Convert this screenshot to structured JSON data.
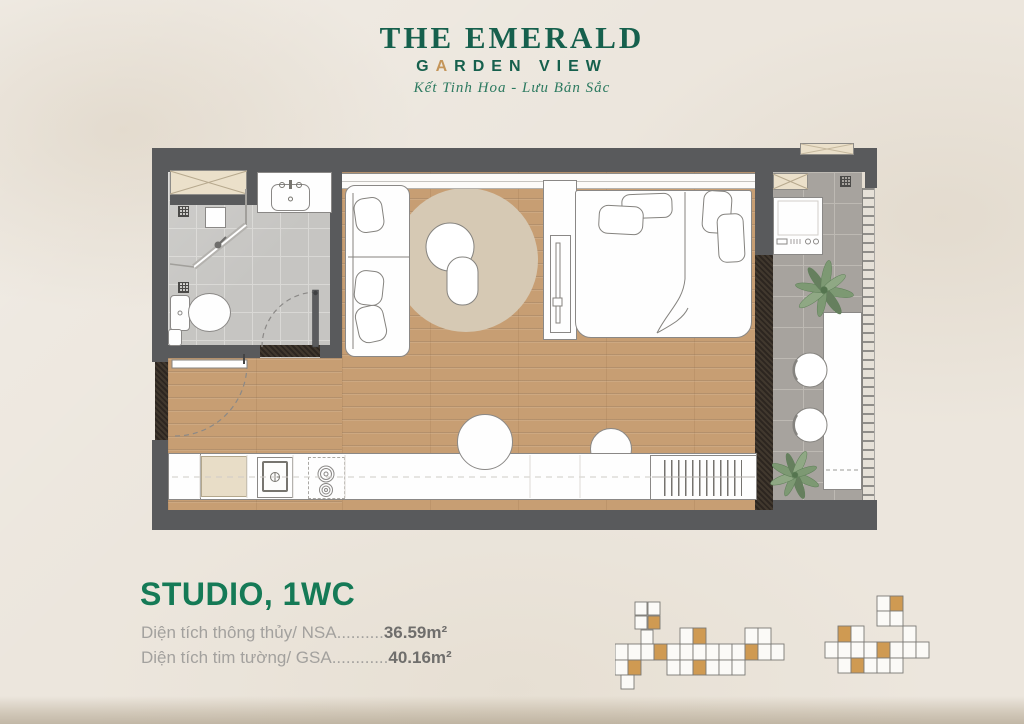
{
  "brand": {
    "line1": "THE EMERALD",
    "line2": "GARDEN VIEW",
    "line2_parts": {
      "pre": "G",
      "mid": "A",
      "post": "RDEN VIEW"
    },
    "tagline": "Kết Tinh Hoa - Lưu Bản Sắc"
  },
  "plan_info": {
    "title": "STUDIO, 1WC",
    "rows": [
      {
        "label": "Diện tích thông thủy/ NSA",
        "dots": "..........",
        "value": "36.59m²"
      },
      {
        "label": "Diện tích tim tường/ GSA",
        "dots": "............",
        "value": "40.16m²"
      }
    ]
  },
  "colors": {
    "brand_green": "#16604d",
    "accent_gold": "#c49559",
    "title_green": "#157a56",
    "wall_gray": "#595a5c",
    "wood_floor": "#c79e73",
    "bathroom_tile": "#c6c5c2",
    "balcony_tile": "#a7a39e",
    "keyplan_highlight_orange": "#cf9a52",
    "background_cream": "#ece6dd"
  }
}
